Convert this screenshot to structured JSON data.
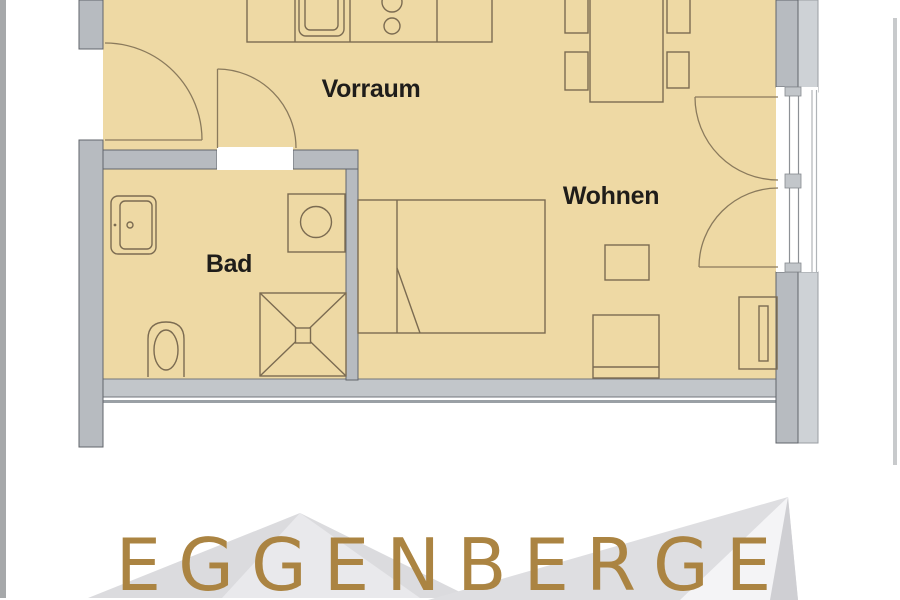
{
  "page": {
    "background": "#ffffff"
  },
  "floor_plan": {
    "rooms": [
      {
        "id": "vorraum",
        "label": "Vorraum"
      },
      {
        "id": "wohnen",
        "label": "Wohnen"
      },
      {
        "id": "bad",
        "label": "Bad"
      }
    ],
    "colors": {
      "floor": "#eed9a4",
      "wall": "#b7bbc0",
      "wall_light": "#ced2d6",
      "furniture_line": "#7b6b51",
      "label_text": "#1f1d1a"
    },
    "fixtures": [
      "kitchen-counter",
      "kitchen-sink",
      "cooktop",
      "dining-table",
      "dining-chairs",
      "entrance-door",
      "bathroom-door",
      "balcony-double-door",
      "balcony-railing",
      "bed",
      "side-table",
      "armchair",
      "wardrobe",
      "bathroom-sink",
      "washing-machine",
      "toilet",
      "shower"
    ]
  },
  "branding": {
    "wordmark": "EGGENBERGE",
    "color": "#ab8442",
    "logo": "mountain-logo"
  }
}
